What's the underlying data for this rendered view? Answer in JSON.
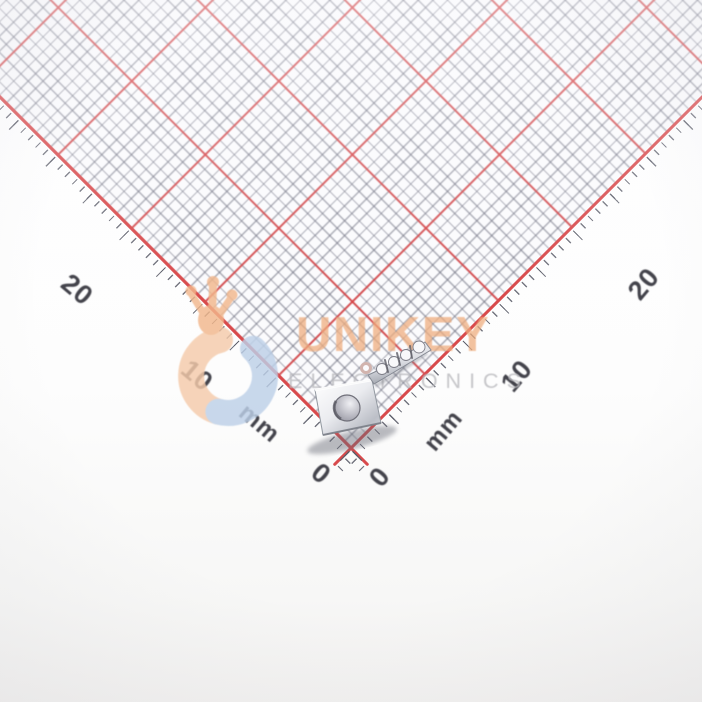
{
  "photo_subject": "metal crimp terminal lying on millimeter grid paper",
  "watermark": {
    "brand": "UNIKEY",
    "subtitle": "ELECTRONICS",
    "brand_color": "#efac7c",
    "subtitle_color": "#b9b9bd",
    "logo_flame_color": "#f2b78c",
    "logo_ring_left_color": "#f5cbab",
    "logo_ring_right_color": "#bdd0e8"
  },
  "ruler": {
    "unit": "mm",
    "minor_step_mm": 1,
    "major_step_mm": 10,
    "minor_line_color": "#8f91a0",
    "major_line_color": "#d84a4c",
    "tick_color": "#5c5e6a",
    "label_color": "#43434b",
    "left_labels": [
      "20",
      "10",
      "mm",
      "0"
    ],
    "right_labels": [
      "0",
      "mm",
      "10",
      "20"
    ]
  }
}
